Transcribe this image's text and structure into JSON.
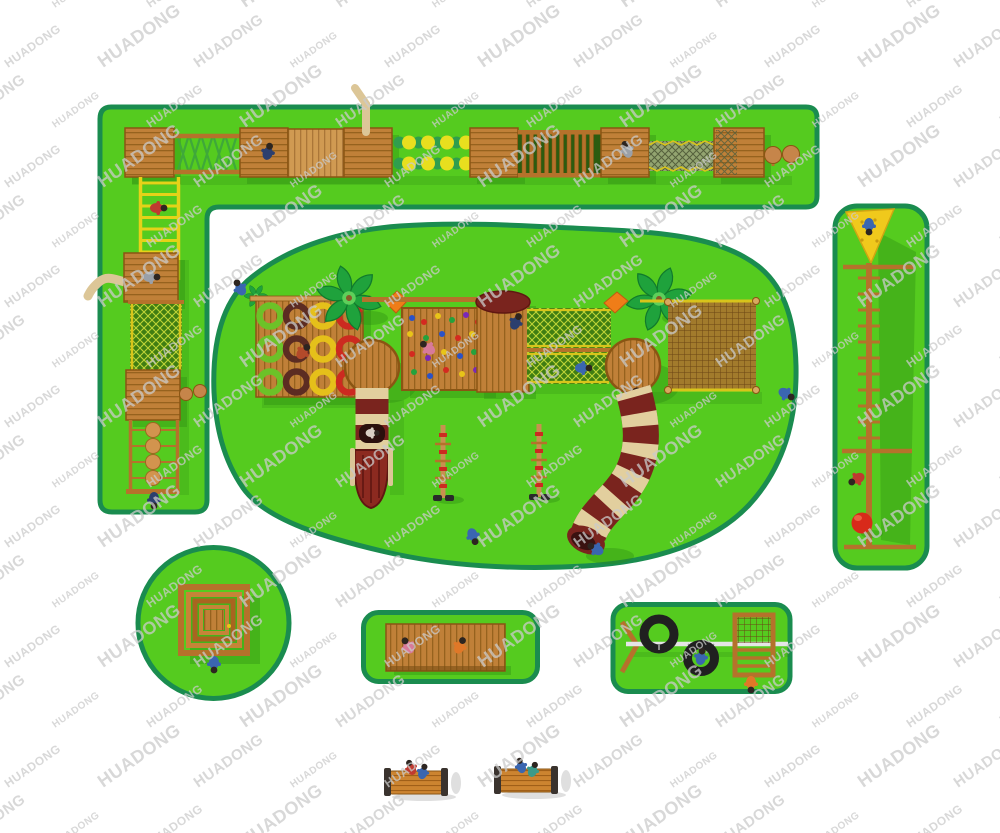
{
  "watermark": {
    "text": "HUADONG"
  },
  "palette": {
    "watermark": "#cbcbcb",
    "grass": "#55cb1f",
    "grass_border": "#1a8c4f",
    "wood": "#c08038",
    "wood_line": "#96621e",
    "wood_light": "#d09a52",
    "wood_light_line": "#aa7638",
    "wood_dark": "#8a5513",
    "beam": "#b5722b",
    "post_tan": "#d8a860",
    "ladder_yellow": "#e6d218",
    "net_base": "#3f7d12",
    "net_line": "#bfd437",
    "net_rail": "#d8c41a",
    "rope_net": "#a9742e",
    "rope_line": "#6b4414",
    "chain_net": "#93a470",
    "slide_red": "#7a241e",
    "slide_red_deep": "#5f1712",
    "slide_cream": "#e2cf9e",
    "slide_beige": "#dcc697",
    "ring_green": "#6cc228",
    "ring_brown": "#5c2c22",
    "ring_yellow": "#e5c01a",
    "ring_red": "#cc2a20",
    "ball_teal": "#2f9e4e",
    "ball_yellow": "#e8df1e",
    "ball_tan": "#c6854a",
    "palm": "#1fa23c",
    "palm_mid": "#5ecf5a",
    "orange": "#ef7d18",
    "triangle_yellow": "#f0c91c",
    "red_ball": "#d82a1a",
    "tire": "#202020",
    "white_beam": "#e5e5e5",
    "bench_wood": "#cc8430",
    "bench_line": "#a05f18",
    "bench_cap": "#3a332e",
    "shadow_green": "#2e8c12",
    "shadow_gray": "#c9c9c9",
    "kid_blue": "#3a66b0",
    "kid_navy": "#2c3f6e",
    "kid_red": "#c03a30",
    "kid_gray": "#9aa0a8",
    "kid_pink": "#d87a9a",
    "kid_orange": "#e07828",
    "kid_teal": "#3a9a8a"
  }
}
